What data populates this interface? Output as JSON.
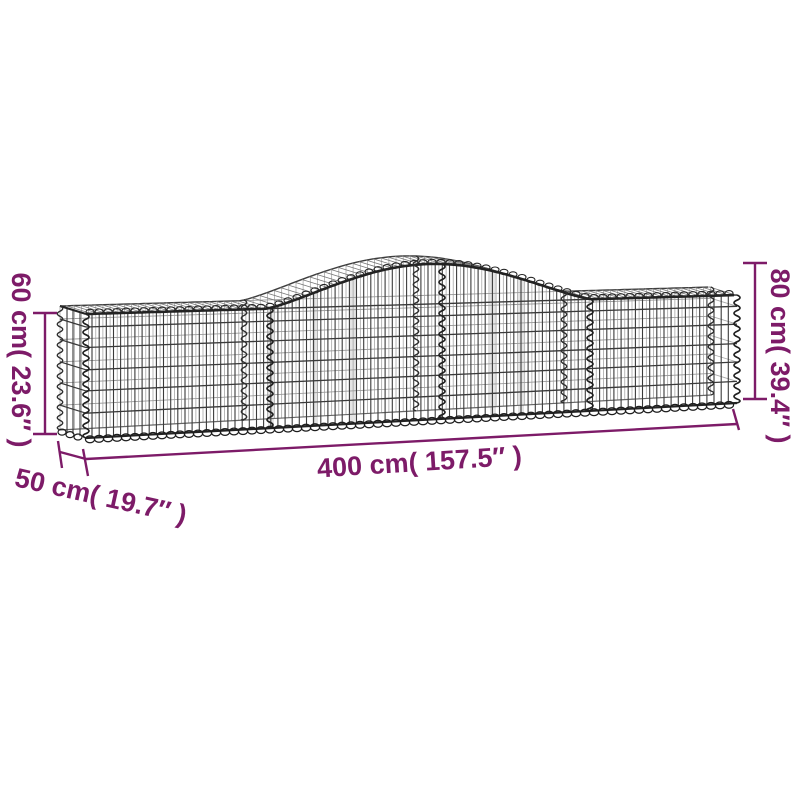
{
  "illustration": {
    "subject": "arched gabion wire mesh basket",
    "style": "3d line drawing, perspective from front-left"
  },
  "colors": {
    "accent": "#7d1b68",
    "wire": "#3a3a3a",
    "wire_dark": "#232323",
    "wire_light": "#9a9a9a",
    "background": "#ffffff"
  },
  "dimensions": {
    "length": {
      "cm": "400",
      "inch": "157.5",
      "label": "400 cm( 157.5″ )"
    },
    "depth": {
      "cm": "50",
      "inch": "19.7",
      "label": "50 cm( 19.7″ )"
    },
    "height_end": {
      "cm": "60",
      "inch": "23.6",
      "label": "60 cm( 23.6″ )"
    },
    "height_peak": {
      "cm": "80",
      "inch": "39.4",
      "label": "80 cm( 39.4″ )"
    }
  }
}
